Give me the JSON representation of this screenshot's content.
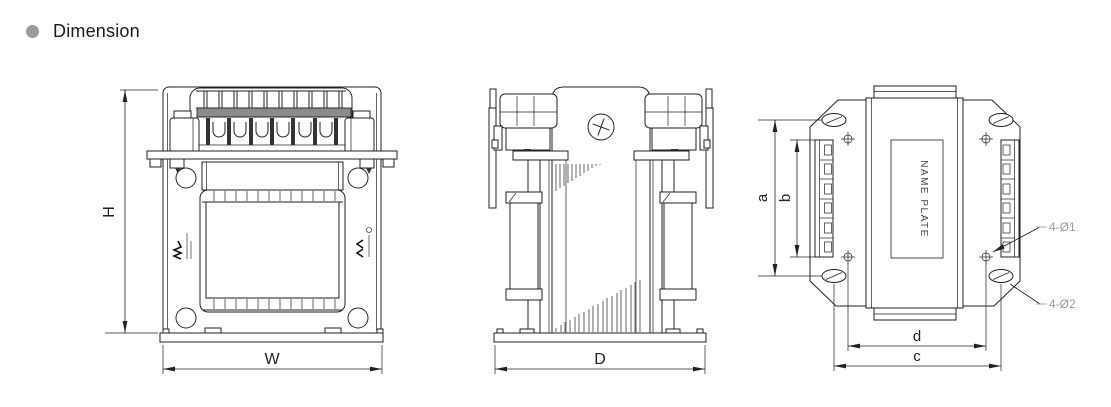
{
  "header": {
    "title": "Dimension",
    "bullet_color": "#9c9c9c"
  },
  "front_view": {
    "dim_height": "H",
    "dim_width": "W"
  },
  "side_view": {
    "dim_depth": "D"
  },
  "top_view": {
    "dim_a": "a",
    "dim_b": "b",
    "dim_d": "d",
    "dim_c": "c",
    "name_plate_text": "NAME PLATE",
    "callouts": {
      "top": "4-Ø1",
      "bottom": "4-Ø2"
    }
  },
  "colors": {
    "line": "#222222",
    "callout_text": "#9a9a9a",
    "terminal_bar": "#8a8a8a"
  }
}
